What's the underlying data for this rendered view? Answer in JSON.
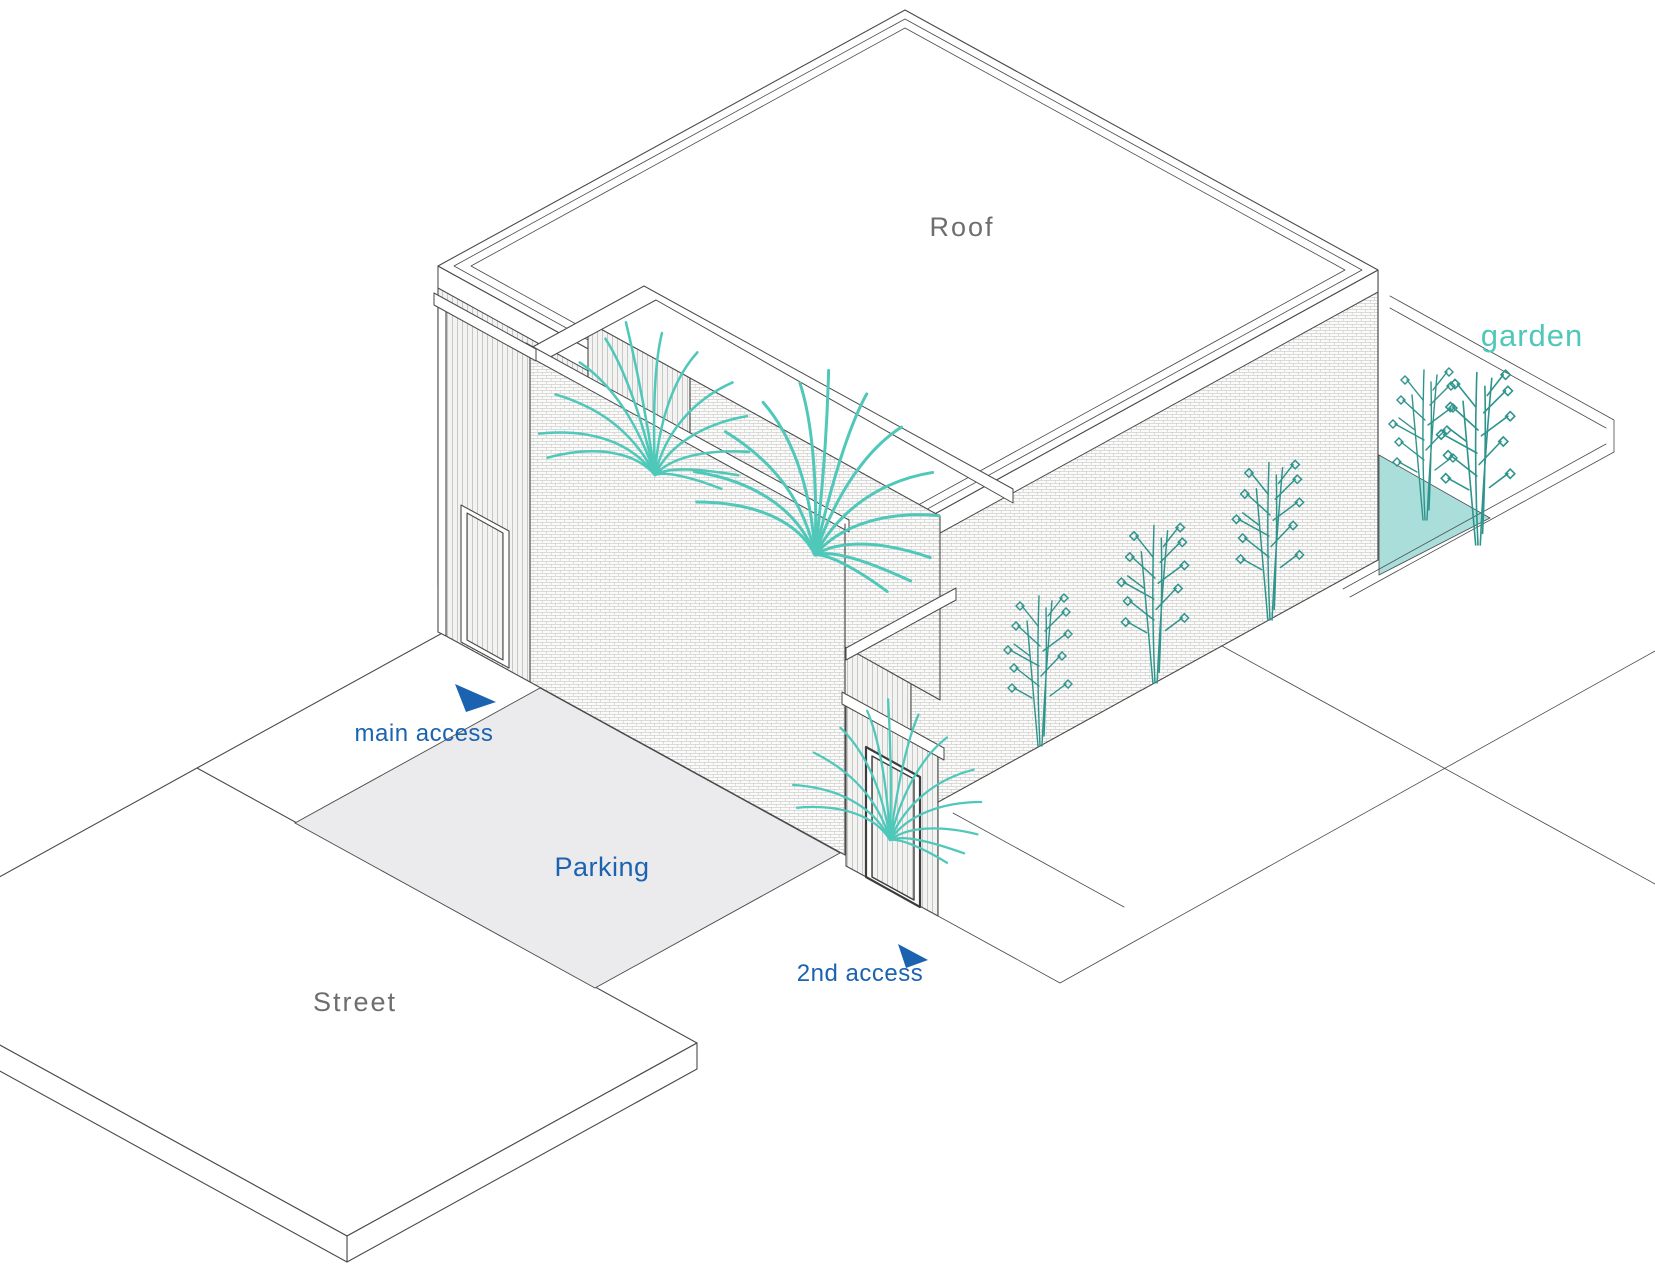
{
  "diagram": {
    "type": "axonometric-architecture-site-diagram",
    "labels": {
      "roof": "Roof",
      "garden": "garden",
      "main_access": "main access",
      "parking": "Parking",
      "second_access": "2nd access",
      "street": "Street"
    },
    "colors": {
      "teal_accent": "#4fc8ba",
      "teal_dark": "#2f948c",
      "garden_floor": "#a9dedb",
      "blue_accent": "#1b63b0",
      "gray_label": "#6e6e6e",
      "line": "#4a4a4a",
      "parking_fill": "#ebebed"
    }
  }
}
